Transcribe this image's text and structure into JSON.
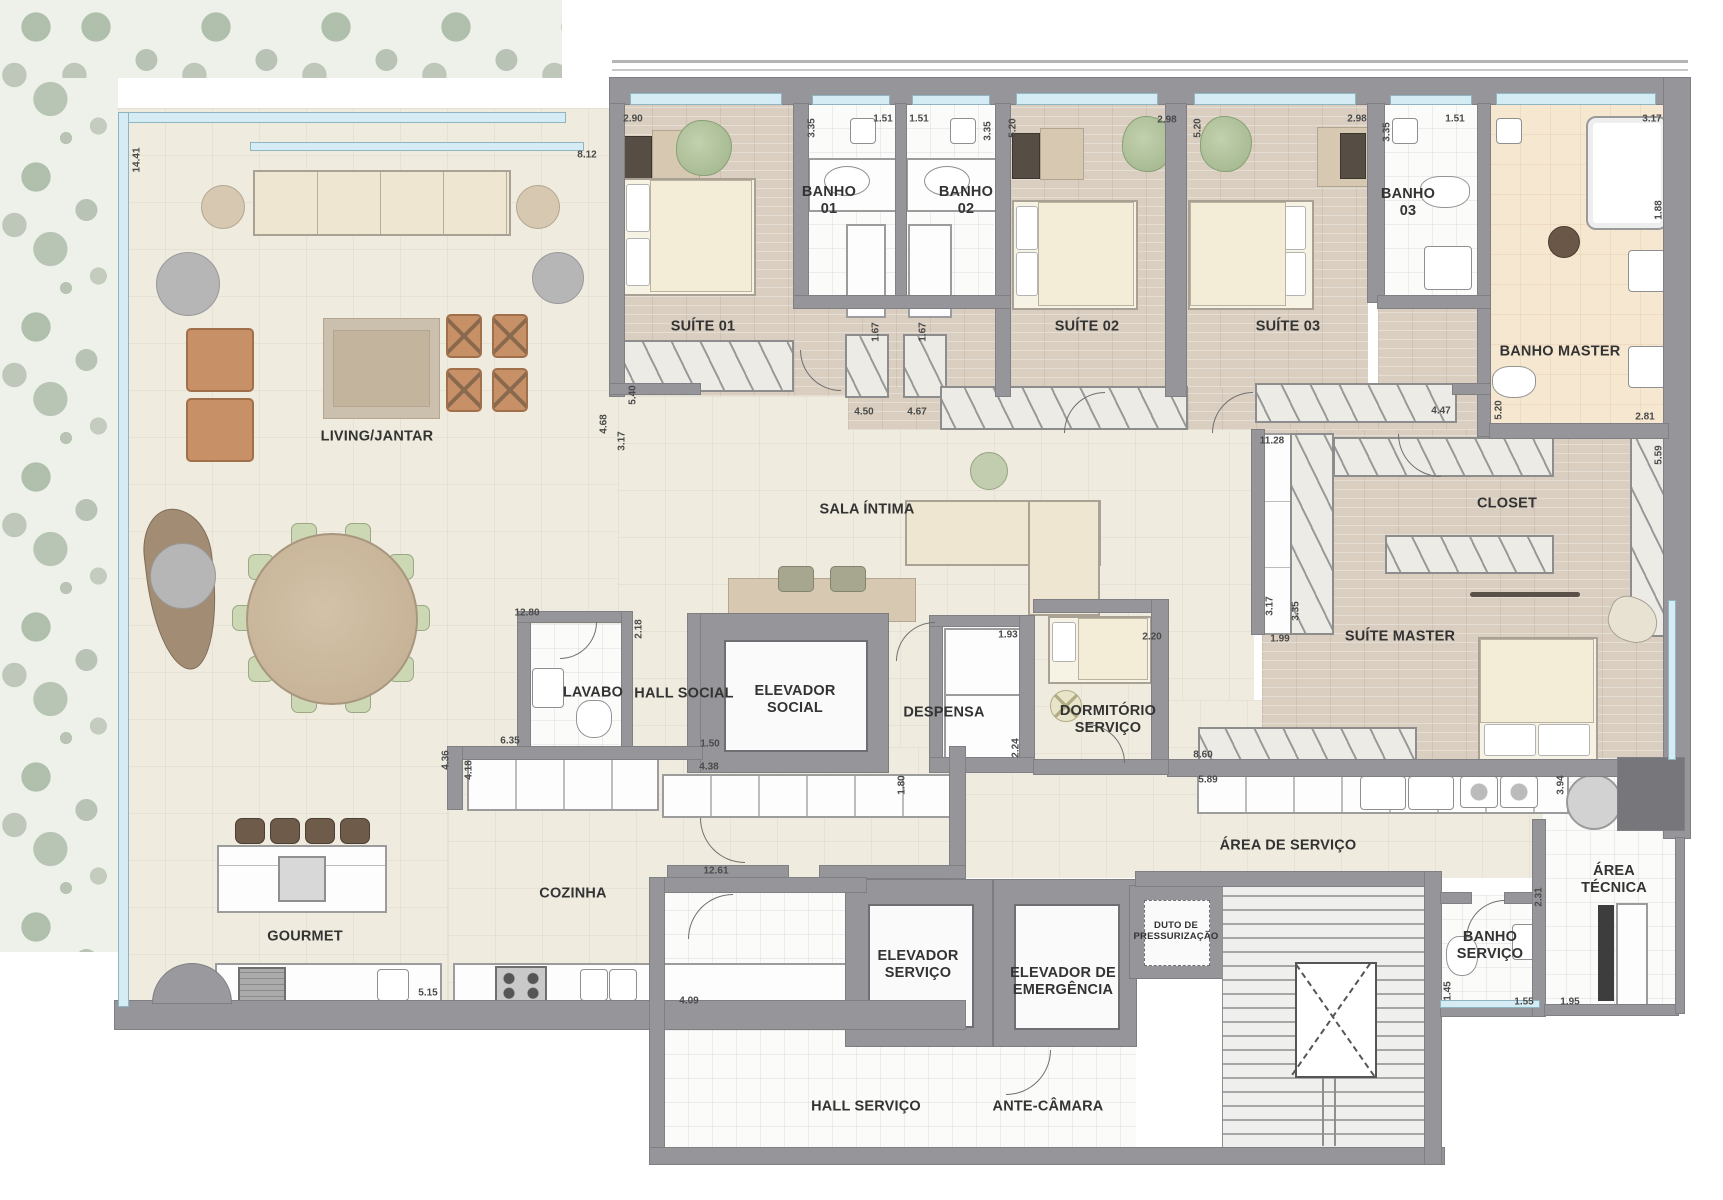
{
  "plan": {
    "type": "residential-floor-plan",
    "colors": {
      "wall": "#96969a",
      "floor_cream": "#efecdf",
      "floor_wood": "#d9cec0",
      "floor_bath": "#fbfbfa",
      "floor_master_bath": "#f6e7d0",
      "greenery": "#aabfa5",
      "glass": "#d6ecf4"
    },
    "rooms": [
      {
        "id": "living-jantar",
        "label": "LIVING/JANTAR",
        "x": 377,
        "y": 437
      },
      {
        "id": "suite-01",
        "label": "SUÍTE 01",
        "x": 703,
        "y": 327
      },
      {
        "id": "banho-01",
        "label": "BANHO\n01",
        "x": 829,
        "y": 201
      },
      {
        "id": "banho-02",
        "label": "BANHO\n02",
        "x": 966,
        "y": 201
      },
      {
        "id": "suite-02",
        "label": "SUÍTE 02",
        "x": 1087,
        "y": 327
      },
      {
        "id": "suite-03",
        "label": "SUÍTE 03",
        "x": 1288,
        "y": 327
      },
      {
        "id": "banho-03",
        "label": "BANHO\n03",
        "x": 1408,
        "y": 203
      },
      {
        "id": "banho-master",
        "label": "BANHO MASTER",
        "x": 1560,
        "y": 352
      },
      {
        "id": "sala-intima",
        "label": "SALA ÍNTIMA",
        "x": 867,
        "y": 510
      },
      {
        "id": "closet",
        "label": "CLOSET",
        "x": 1507,
        "y": 504
      },
      {
        "id": "suite-master",
        "label": "SUÍTE MASTER",
        "x": 1400,
        "y": 637
      },
      {
        "id": "lavabo",
        "label": "LAVABO",
        "x": 593,
        "y": 693
      },
      {
        "id": "hall-social",
        "label": "HALL SOCIAL",
        "x": 684,
        "y": 694
      },
      {
        "id": "elevador-social",
        "label": "ELEVADOR\nSOCIAL",
        "x": 795,
        "y": 700
      },
      {
        "id": "despensa",
        "label": "DESPENSA",
        "x": 944,
        "y": 713
      },
      {
        "id": "dormitorio-servico",
        "label": "DORMITÓRIO\nSERVIÇO",
        "x": 1108,
        "y": 720
      },
      {
        "id": "area-de-servico",
        "label": "ÁREA DE SERVIÇO",
        "x": 1288,
        "y": 846
      },
      {
        "id": "area-tecnica",
        "label": "ÁREA TÉCNICA",
        "x": 1614,
        "y": 880
      },
      {
        "id": "banho-servico",
        "label": "BANHO\nSERVIÇO",
        "x": 1490,
        "y": 946
      },
      {
        "id": "cozinha",
        "label": "COZINHA",
        "x": 573,
        "y": 894
      },
      {
        "id": "gourmet",
        "label": "GOURMET",
        "x": 305,
        "y": 937
      },
      {
        "id": "elevador-servico",
        "label": "ELEVADOR\nSERVIÇO",
        "x": 918,
        "y": 965
      },
      {
        "id": "elevador-emergencia",
        "label": "ELEVADOR DE\nEMERGÊNCIA",
        "x": 1063,
        "y": 982
      },
      {
        "id": "duto-pressurizacao",
        "label": "DUTO DE\nPRESSURIZAÇÃO",
        "x": 1176,
        "y": 931,
        "small": true
      },
      {
        "id": "hall-servico",
        "label": "HALL SERVIÇO",
        "x": 866,
        "y": 1107
      },
      {
        "id": "ante-camara",
        "label": "ANTE-CÂMARA",
        "x": 1048,
        "y": 1107
      }
    ],
    "dimensions": [
      {
        "t": "14.41",
        "x": 137,
        "y": 160,
        "v": 1
      },
      {
        "t": "8.12",
        "x": 587,
        "y": 155
      },
      {
        "t": "2.90",
        "x": 633,
        "y": 119
      },
      {
        "t": "3.35",
        "x": 812,
        "y": 128,
        "v": 1
      },
      {
        "t": "1.51",
        "x": 883,
        "y": 119
      },
      {
        "t": "1.51",
        "x": 919,
        "y": 119
      },
      {
        "t": "3.35",
        "x": 988,
        "y": 131,
        "v": 1
      },
      {
        "t": "5.20",
        "x": 1013,
        "y": 128,
        "v": 1
      },
      {
        "t": "2.98",
        "x": 1167,
        "y": 120
      },
      {
        "t": "5.20",
        "x": 1198,
        "y": 128,
        "v": 1
      },
      {
        "t": "2.98",
        "x": 1357,
        "y": 119
      },
      {
        "t": "3.35",
        "x": 1387,
        "y": 132,
        "v": 1
      },
      {
        "t": "1.51",
        "x": 1455,
        "y": 119
      },
      {
        "t": "3.17",
        "x": 1652,
        "y": 119
      },
      {
        "t": "1.88",
        "x": 1659,
        "y": 210,
        "v": 1
      },
      {
        "t": "1.67",
        "x": 876,
        "y": 332,
        "v": 1
      },
      {
        "t": "1.67",
        "x": 923,
        "y": 332,
        "v": 1
      },
      {
        "t": "5.40",
        "x": 633,
        "y": 395,
        "v": 1
      },
      {
        "t": "4.50",
        "x": 864,
        "y": 412
      },
      {
        "t": "4.67",
        "x": 917,
        "y": 412
      },
      {
        "t": "4.68",
        "x": 604,
        "y": 424,
        "v": 1
      },
      {
        "t": "3.17",
        "x": 622,
        "y": 441,
        "v": 1
      },
      {
        "t": "4.47",
        "x": 1441,
        "y": 411
      },
      {
        "t": "11.28",
        "x": 1272,
        "y": 441
      },
      {
        "t": "2.81",
        "x": 1645,
        "y": 417
      },
      {
        "t": "5.20",
        "x": 1499,
        "y": 410,
        "v": 1
      },
      {
        "t": "5.59",
        "x": 1659,
        "y": 455,
        "v": 1
      },
      {
        "t": "3.17",
        "x": 1270,
        "y": 606,
        "v": 1
      },
      {
        "t": "3.35",
        "x": 1296,
        "y": 611,
        "v": 1
      },
      {
        "t": "1.99",
        "x": 1280,
        "y": 639
      },
      {
        "t": "2.20",
        "x": 1152,
        "y": 637
      },
      {
        "t": "1.93",
        "x": 1008,
        "y": 635
      },
      {
        "t": "12.80",
        "x": 527,
        "y": 613
      },
      {
        "t": "2.18",
        "x": 639,
        "y": 629,
        "v": 1
      },
      {
        "t": "2.24",
        "x": 1016,
        "y": 748,
        "v": 1
      },
      {
        "t": "1.80",
        "x": 902,
        "y": 785,
        "v": 1
      },
      {
        "t": "6.35",
        "x": 510,
        "y": 741
      },
      {
        "t": "1.50",
        "x": 710,
        "y": 744
      },
      {
        "t": "4.38",
        "x": 709,
        "y": 767
      },
      {
        "t": "4.36",
        "x": 446,
        "y": 760,
        "v": 1
      },
      {
        "t": "4.18",
        "x": 469,
        "y": 770,
        "v": 1
      },
      {
        "t": "8.60",
        "x": 1203,
        "y": 755
      },
      {
        "t": "5.89",
        "x": 1208,
        "y": 780
      },
      {
        "t": "12.61",
        "x": 716,
        "y": 871
      },
      {
        "t": "4.09",
        "x": 689,
        "y": 1001
      },
      {
        "t": "5.15",
        "x": 428,
        "y": 993
      },
      {
        "t": "3.94",
        "x": 1561,
        "y": 785,
        "v": 1
      },
      {
        "t": "2.31",
        "x": 1539,
        "y": 897,
        "v": 1
      },
      {
        "t": "1.45",
        "x": 1448,
        "y": 991,
        "v": 1
      },
      {
        "t": "1.55",
        "x": 1524,
        "y": 1002
      },
      {
        "t": "1.95",
        "x": 1570,
        "y": 1002
      }
    ]
  }
}
